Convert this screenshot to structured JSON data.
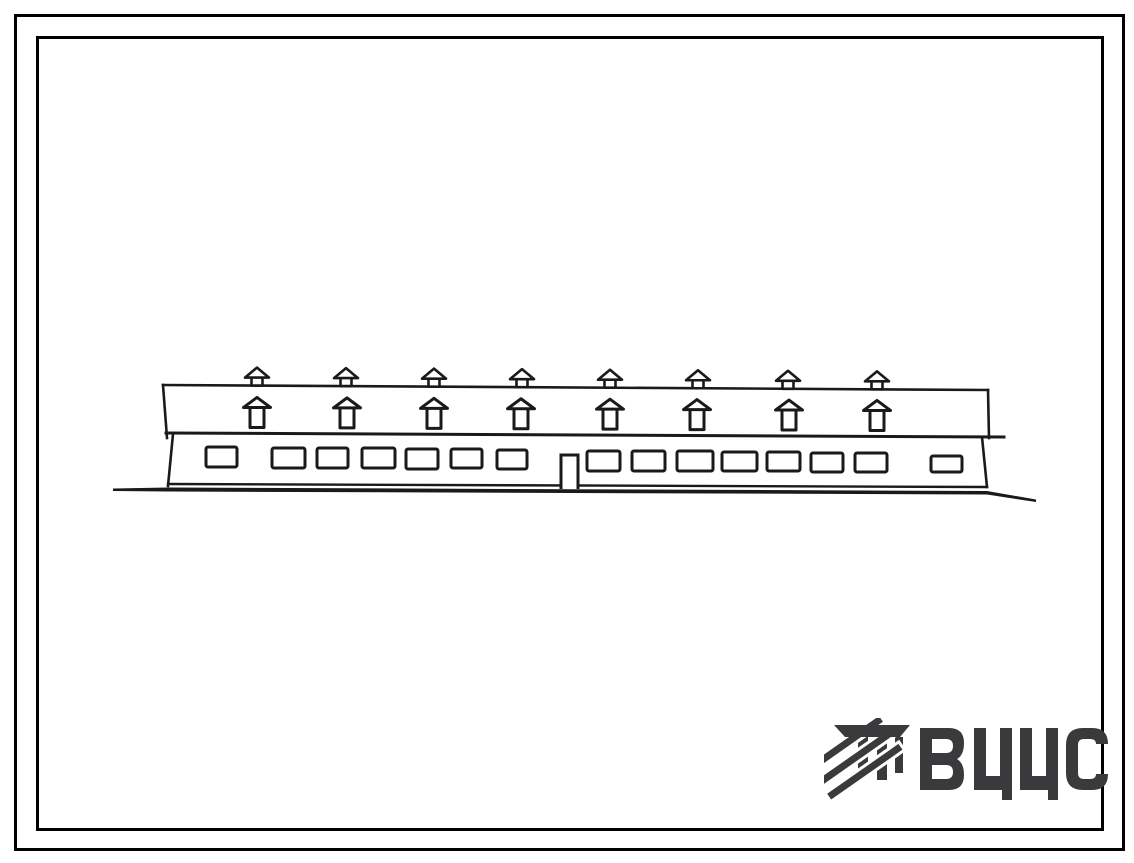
{
  "frames": {
    "color": "#000000"
  },
  "logo": {
    "text": "ВЦИС",
    "color": "#3a3a3c"
  },
  "drawing": {
    "ink": "#1a1a1a",
    "description": "facade-elevation-of-long-single-storey-building",
    "lines": [
      [
        163,
        385,
        988,
        390,
        2.6
      ],
      [
        163,
        385,
        167,
        438,
        2.6
      ],
      [
        988,
        390,
        989,
        438,
        2.6
      ],
      [
        166,
        433,
        1004,
        437,
        3
      ],
      [
        173,
        434,
        168,
        486,
        2.6
      ],
      [
        982,
        437,
        987,
        487,
        2.6
      ],
      [
        168,
        484,
        987,
        487,
        2.4
      ]
    ],
    "ground_polygon": "113,488.5 168,487.5 987,491 1036,499.5 1036,502 987,494.5 168,491.5 113,491",
    "windows": [
      [
        206,
        447,
        31,
        20
      ],
      [
        272,
        448,
        33,
        20
      ],
      [
        317,
        448,
        31,
        20
      ],
      [
        362,
        448,
        33,
        20
      ],
      [
        406,
        449,
        32,
        20
      ],
      [
        451,
        449,
        31,
        19
      ],
      [
        497,
        450,
        30,
        19
      ],
      [
        587,
        451,
        33,
        20
      ],
      [
        632,
        451,
        33,
        20
      ],
      [
        677,
        451,
        36,
        20
      ],
      [
        722,
        452,
        35,
        19
      ],
      [
        767,
        452,
        33,
        19
      ],
      [
        811,
        453,
        32,
        19
      ],
      [
        855,
        453,
        32,
        19
      ],
      [
        931,
        456,
        31,
        16
      ]
    ],
    "door": {
      "d": "M561,489 V455 H578 V489",
      "stroke": 3
    },
    "vents": {
      "top": {
        "xs": [
          257,
          346,
          434,
          522,
          610,
          698,
          788,
          877
        ],
        "line": [
          163,
          385,
          988,
          390
        ],
        "symbol": "vent-small"
      },
      "bottom": {
        "xs": [
          257,
          347,
          434,
          521,
          610,
          697,
          789,
          877
        ],
        "line": [
          163,
          427,
          988,
          431
        ],
        "symbol": "vent-large"
      }
    }
  }
}
